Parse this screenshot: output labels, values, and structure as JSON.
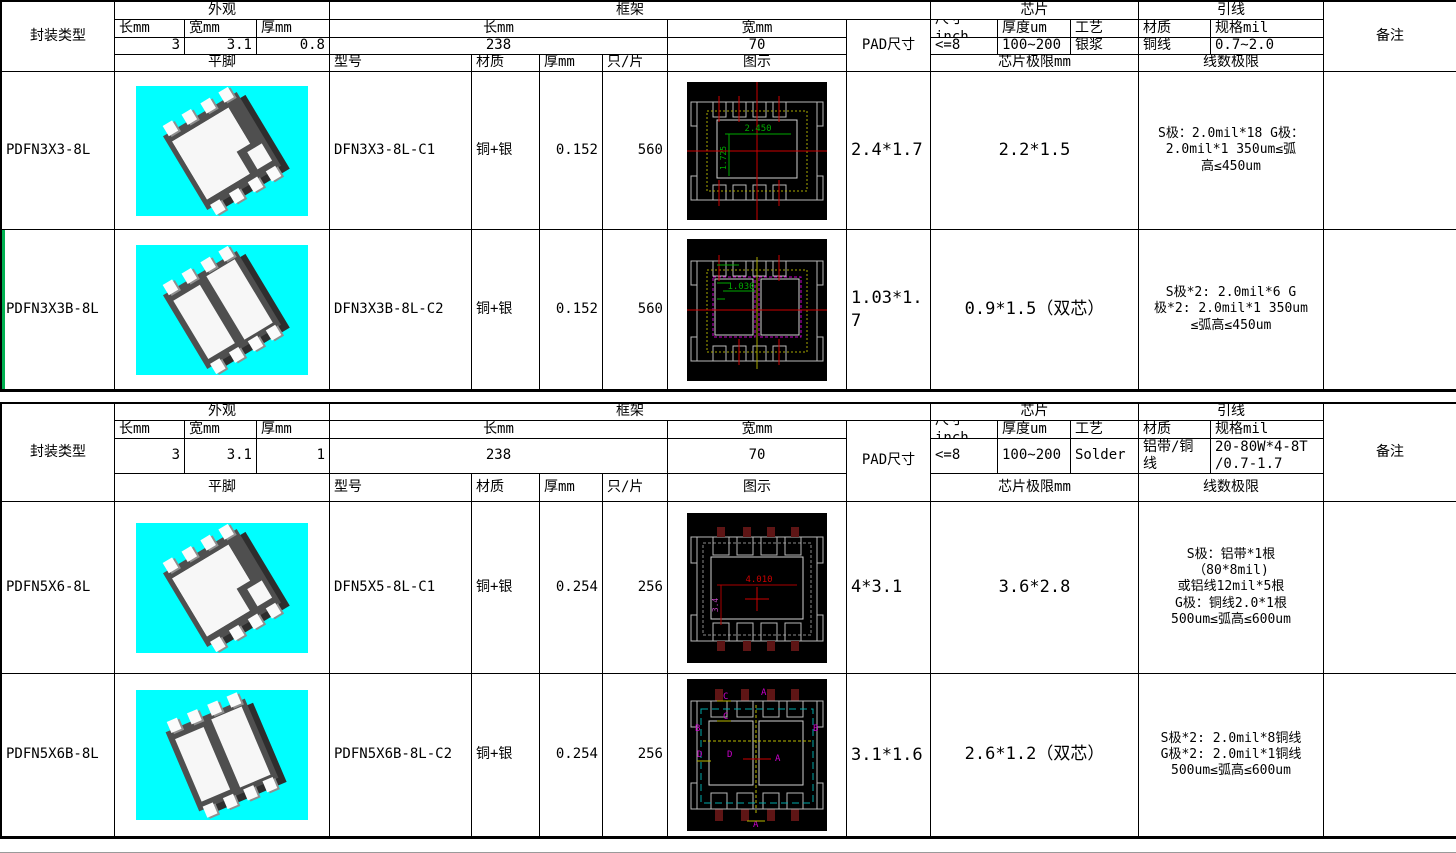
{
  "colors": {
    "photo_bg": "#00ffff",
    "grid_border": "#000000",
    "page_break_marker": "#00b050",
    "cad_bg": "#000000",
    "cad_outline": "#b9b9b9",
    "cad_red": "#cc0000",
    "cad_green": "#00a800",
    "cad_yellow": "#a8a800",
    "cad_magenta": "#cc00cc",
    "cad_cyan": "#00a8a8"
  },
  "tables": [
    {
      "package_type_label": "封装类型",
      "appearance": {
        "title": "外观",
        "len_label": "长mm",
        "wid_label": "宽mm",
        "thk_label": "厚mm",
        "len": "3",
        "wid": "3.1",
        "thk": "0.8"
      },
      "frame": {
        "title": "框架",
        "len_label": "长mm",
        "wid_label": "宽mm",
        "len": "238",
        "wid": "70"
      },
      "pad_label": "PAD尺寸",
      "chip": {
        "title": "芯片",
        "size_label": "尺寸inch",
        "thick_label": "厚度um",
        "process_label": "工艺",
        "size": "<=8",
        "thick": "100~200",
        "process": "银浆"
      },
      "wire": {
        "title": "引线",
        "material_label": "材质",
        "spec_label": "规格mil",
        "material": "铜线",
        "spec": "0.7~2.0"
      },
      "remark_label": "备注",
      "row_header": {
        "flat": "平脚",
        "model": "型号",
        "material": "材质",
        "thick": "厚mm",
        "per_sheet": "只/片",
        "diagram": "图示",
        "chip_limit": "芯片极限mm",
        "wire_limit": "线数极限"
      },
      "rows": [
        {
          "package_type": "PDFN3X3-8L",
          "model": "DFN3X3-8L-C1",
          "material": "铜+银",
          "thickness": "0.152",
          "per_sheet": "560",
          "pad_size": "2.4*1.7",
          "chip_limit": "2.2*1.5",
          "wire_limit": "S极：2.0mil*18   G极：\n2.0mil*1      350um≤弧\n高≤450um",
          "remark": "",
          "diagram": {
            "dim_h": "2.450",
            "dim_v": "1.725"
          }
        },
        {
          "package_type": "PDFN3X3B-8L",
          "model": "DFN3X3B-8L-C2",
          "material": "铜+银",
          "thickness": "0.152",
          "per_sheet": "560",
          "pad_size": "1.03*1.7",
          "chip_limit": "0.9*1.5（双芯）",
          "wire_limit": "S极*2: 2.0mil*6      G\n极*2: 2.0mil*1   350um\n≤弧高≤450um",
          "remark": "",
          "diagram": {
            "dim_h": "1.030"
          }
        }
      ]
    },
    {
      "package_type_label": "封装类型",
      "appearance": {
        "title": "外观",
        "len_label": "长mm",
        "wid_label": "宽mm",
        "thk_label": "厚mm",
        "len": "3",
        "wid": "3.1",
        "thk": "1"
      },
      "frame": {
        "title": "框架",
        "len_label": "长mm",
        "wid_label": "宽mm",
        "len": "238",
        "wid": "70"
      },
      "pad_label": "PAD尺寸",
      "chip": {
        "title": "芯片",
        "size_label": "尺寸inch",
        "thick_label": "厚度um",
        "process_label": "工艺",
        "size": "<=8",
        "thick": "100~200",
        "process": "Solder"
      },
      "wire": {
        "title": "引线",
        "material_label": "材质",
        "spec_label": "规格mil",
        "material": "铝带/铜线",
        "spec": "20-80W*4-8T\n/0.7-1.7"
      },
      "remark_label": "备注",
      "row_header": {
        "flat": "平脚",
        "model": "型号",
        "material": "材质",
        "thick": "厚mm",
        "per_sheet": "只/片",
        "diagram": "图示",
        "chip_limit": "芯片极限mm",
        "wire_limit": "线数极限"
      },
      "rows": [
        {
          "package_type": "PDFN5X6-8L",
          "model": "DFN5X5-8L-C1",
          "material": "铜+银",
          "thickness": "0.254",
          "per_sheet": "256",
          "pad_size": "4*3.1",
          "chip_limit": "3.6*2.8",
          "wire_limit": "S极：铝带*1根\n（80*8mil)\n或铝线12mil*5根\nG极：铜线2.0*1根\n500um≤弧高≤600um",
          "remark": "",
          "diagram": {
            "dim_h": "4.010",
            "dim_v": "3.4"
          }
        },
        {
          "package_type": "PDFN5X6B-8L",
          "model": "PDFN5X6B-8L-C2",
          "material": "铜+银",
          "thickness": "0.254",
          "per_sheet": "256",
          "pad_size": "3.1*1.6",
          "chip_limit": "2.6*1.2（双芯）",
          "wire_limit": "S极*2: 2.0mil*8铜线\nG极*2: 2.0mil*1铜线\n500um≤弧高≤600um",
          "remark": "",
          "diagram": {
            "labels": [
              "A",
              "B",
              "C",
              "D"
            ]
          }
        }
      ]
    }
  ]
}
